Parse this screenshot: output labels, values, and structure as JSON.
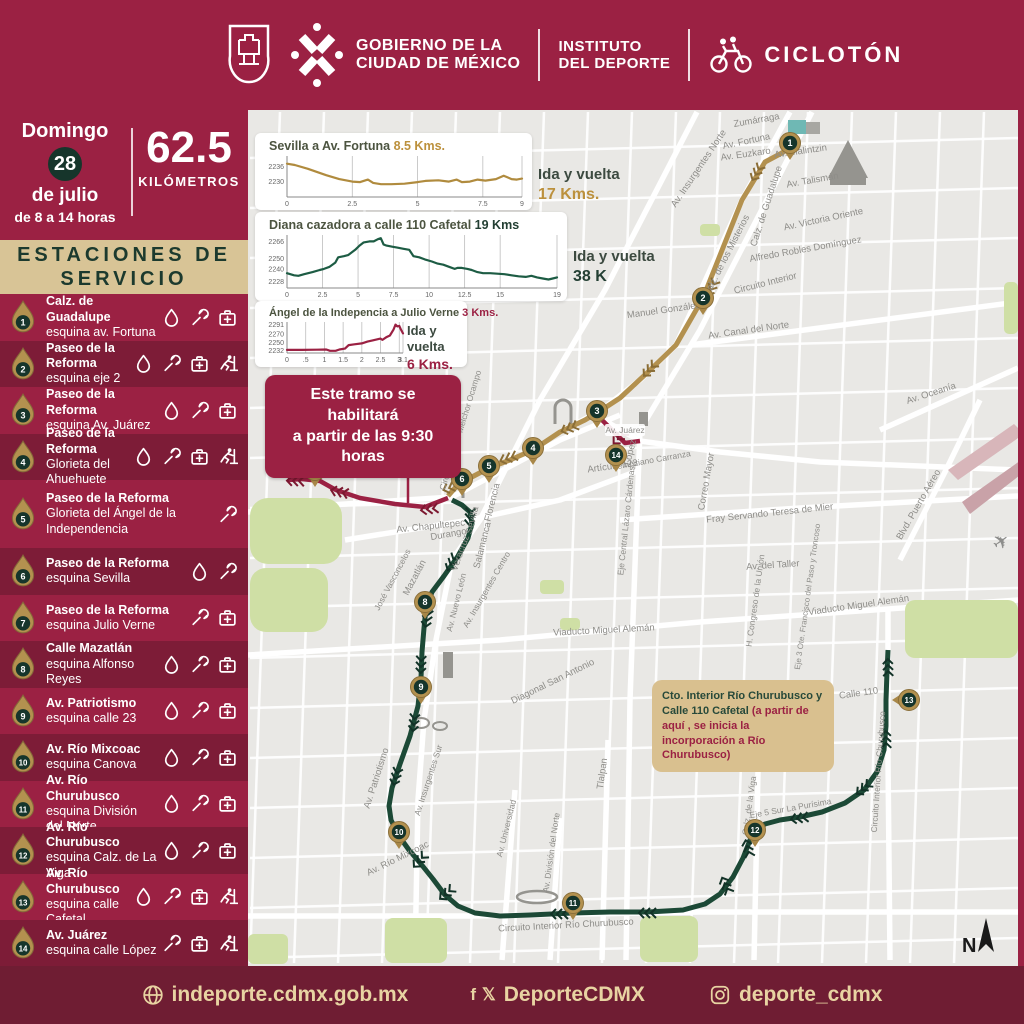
{
  "header": {
    "gov_line1": "GOBIERNO DE LA",
    "gov_line2": "CIUDAD DE MÉXICO",
    "inst_line1": "INSTITUTO",
    "inst_line2": "DEL DEPORTE",
    "event_name": "CICLOTÓN"
  },
  "sidebar": {
    "date": {
      "day_name": "Domingo",
      "day": "28",
      "month": "de julio",
      "hours": "de 8 a 14 horas"
    },
    "distance": {
      "value": "62.5",
      "unit": "KILÓMETROS"
    },
    "stations_title_line1": "ESTACIONES DE",
    "stations_title_line2": "SERVICIO",
    "stations": [
      {
        "num": "1",
        "line1": "Calz. de Guadalupe",
        "line2": "esquina av. Fortuna",
        "amenities": [
          "water",
          "wrench",
          "aid"
        ]
      },
      {
        "num": "2",
        "line1": "Paseo de la Reforma",
        "line2": "esquina eje 2",
        "amenities": [
          "water",
          "wrench",
          "aid",
          "runner"
        ]
      },
      {
        "num": "3",
        "line1": "Paseo de la Reforma",
        "line2": "esquina Av. Juárez",
        "amenities": [
          "water",
          "wrench",
          "aid"
        ]
      },
      {
        "num": "4",
        "line1": "Paseo de la Reforma",
        "line2": "Glorieta del Ahuehuete",
        "amenities": [
          "water",
          "wrench",
          "aid",
          "runner"
        ]
      },
      {
        "num": "5",
        "line1": "Paseo de la Reforma",
        "line2": "Glorieta del Ángel de la Independencia",
        "amenities": [
          "wrench"
        ]
      },
      {
        "num": "6",
        "line1": "Paseo de la Reforma",
        "line2": "esquina Sevilla",
        "amenities": [
          "water",
          "wrench"
        ]
      },
      {
        "num": "7",
        "line1": "Paseo de la Reforma",
        "line2": "esquina Julio Verne",
        "amenities": [
          "wrench",
          "aid"
        ]
      },
      {
        "num": "8",
        "line1": "Calle Mazatlán",
        "line2": "esquina Alfonso Reyes",
        "amenities": [
          "water",
          "wrench",
          "aid"
        ]
      },
      {
        "num": "9",
        "line1": "Av. Patriotismo",
        "line2": "esquina calle 23",
        "amenities": [
          "water",
          "wrench",
          "aid"
        ]
      },
      {
        "num": "10",
        "line1": "Av. Río Mixcoac",
        "line2": "esquina Canova",
        "amenities": [
          "water",
          "wrench",
          "aid"
        ]
      },
      {
        "num": "11",
        "line1": "Av. Río Churubusco",
        "line2": "esquina División del Norte",
        "amenities": [
          "water",
          "wrench",
          "aid"
        ]
      },
      {
        "num": "12",
        "line1": "Av. Río Churubusco",
        "line2": "esquina Calz. de La Viga",
        "amenities": [
          "water",
          "wrench",
          "aid"
        ]
      },
      {
        "num": "13",
        "line1": "Av. Río Churubusco",
        "line2": "esquina calle Cafetal",
        "amenities": [
          "water",
          "wrench",
          "aid",
          "runner"
        ]
      },
      {
        "num": "14",
        "line1": "Av. Juárez",
        "line2": "esquina calle López",
        "amenities": [
          "wrench",
          "aid",
          "runner"
        ]
      }
    ]
  },
  "chart_data": [
    {
      "type": "line",
      "title": "Sevilla a Av. Fortuna ",
      "highlight": "8.5 Kms.",
      "highlight_color": "#bc913d",
      "color": "#b08b3e",
      "note": "Ida y vuelta",
      "note_value": "17 Kms.",
      "note_value_color": "#bc913d",
      "xlim": [
        0,
        9
      ],
      "ylim": [
        2224,
        2240
      ],
      "xticks": [
        "0",
        "2.5",
        "5",
        "7.5",
        "9"
      ],
      "yticks": [
        2236,
        2230
      ],
      "points": [
        [
          0,
          2237
        ],
        [
          0.3,
          2236.5
        ],
        [
          0.8,
          2235
        ],
        [
          1.5,
          2232.5
        ],
        [
          2,
          2231
        ],
        [
          2.5,
          2230
        ],
        [
          2.8,
          2229.8
        ],
        [
          3.1,
          2230.8
        ],
        [
          3.3,
          2229.5
        ],
        [
          3.6,
          2229
        ],
        [
          4,
          2229
        ],
        [
          4.5,
          2229.2
        ],
        [
          5,
          2229.8
        ],
        [
          5.3,
          2230.3
        ],
        [
          5.8,
          2230.5
        ],
        [
          6.2,
          2230
        ],
        [
          6.5,
          2230.8
        ],
        [
          6.7,
          2229.8
        ],
        [
          7,
          2230
        ],
        [
          7.3,
          2230.8
        ],
        [
          7.6,
          2230.4
        ],
        [
          8,
          2231
        ],
        [
          8.3,
          2232.3
        ],
        [
          8.6,
          2231
        ],
        [
          8.8,
          2230.8
        ],
        [
          9,
          2231.2
        ]
      ]
    },
    {
      "type": "line",
      "title": "Diana cazadora a calle 110 Cafetal ",
      "highlight": "19 Kms",
      "highlight_color": "#233f33",
      "color": "#1d5c44",
      "note": "Ida y vuelta",
      "note_value": "38 K",
      "note_value_color": "#233f33",
      "xlim": [
        0,
        19
      ],
      "ylim": [
        2222,
        2272
      ],
      "xticks": [
        "0",
        "2.5",
        "5",
        "7.5",
        "10",
        "12.5",
        "15",
        "19"
      ],
      "yticks": [
        2266,
        2250,
        2240,
        2228
      ],
      "points": [
        [
          0,
          2236
        ],
        [
          0.5,
          2234
        ],
        [
          0.8,
          2233.5
        ],
        [
          1.2,
          2235
        ],
        [
          1.8,
          2237
        ],
        [
          2.3,
          2239
        ],
        [
          2.6,
          2240
        ],
        [
          3,
          2242
        ],
        [
          3.4,
          2246
        ],
        [
          3.6,
          2251
        ],
        [
          4,
          2252
        ],
        [
          4.3,
          2253
        ],
        [
          4.8,
          2258
        ],
        [
          5.1,
          2262
        ],
        [
          5.4,
          2265
        ],
        [
          5.8,
          2266
        ],
        [
          6.1,
          2266
        ],
        [
          6.4,
          2268
        ],
        [
          6.6,
          2269
        ],
        [
          6.8,
          2263
        ],
        [
          7,
          2262
        ],
        [
          7.4,
          2261
        ],
        [
          7.8,
          2260
        ],
        [
          8.2,
          2259
        ],
        [
          8.6,
          2258
        ],
        [
          8.9,
          2252
        ],
        [
          9.3,
          2251
        ],
        [
          9.7,
          2249
        ],
        [
          10.2,
          2247
        ],
        [
          10.6,
          2245
        ],
        [
          11,
          2244
        ],
        [
          11.4,
          2242
        ],
        [
          11.8,
          2240
        ],
        [
          12,
          2241
        ],
        [
          12.3,
          2241
        ],
        [
          12.7,
          2240
        ],
        [
          13,
          2239
        ],
        [
          13.4,
          2237
        ],
        [
          13.8,
          2236
        ],
        [
          14.3,
          2236
        ],
        [
          14.8,
          2235.5
        ],
        [
          15.3,
          2235
        ],
        [
          15.8,
          2234
        ],
        [
          16.3,
          2233
        ],
        [
          16.8,
          2232.5
        ],
        [
          17.2,
          2233.5
        ],
        [
          17.6,
          2232
        ],
        [
          18,
          2231
        ],
        [
          18.4,
          2230
        ],
        [
          18.7,
          2231
        ],
        [
          19,
          2232
        ]
      ]
    },
    {
      "type": "line",
      "title": "Ángel de la Indepencia a Julio Verne ",
      "highlight": "3 Kms.",
      "highlight_color": "#9b2143",
      "color": "#9b2143",
      "note": "Ida y vuelta",
      "note_value": "6 Kms.",
      "note_value_color": "#9b2143",
      "xlim": [
        0,
        3.1
      ],
      "ylim": [
        2226,
        2297
      ],
      "xticks": [
        "0",
        ".5",
        "1",
        "1.5",
        "2",
        "2.5",
        "3",
        "3.1"
      ],
      "yticks": [
        2291,
        2270,
        2250,
        2232
      ],
      "points": [
        [
          0,
          2233
        ],
        [
          0.4,
          2233
        ],
        [
          0.8,
          2233.5
        ],
        [
          1.05,
          2234
        ],
        [
          1.15,
          2231
        ],
        [
          1.3,
          2231
        ],
        [
          1.4,
          2234
        ],
        [
          1.55,
          2236
        ],
        [
          1.65,
          2244
        ],
        [
          1.8,
          2246
        ],
        [
          2,
          2248
        ],
        [
          2.15,
          2252
        ],
        [
          2.3,
          2255
        ],
        [
          2.5,
          2259
        ],
        [
          2.55,
          2256
        ],
        [
          2.65,
          2262
        ],
        [
          2.75,
          2266
        ],
        [
          2.85,
          2280
        ],
        [
          2.9,
          2291
        ],
        [
          2.95,
          2287
        ],
        [
          3,
          2288
        ],
        [
          3.05,
          2279
        ],
        [
          3.1,
          2271
        ]
      ]
    }
  ],
  "callouts": {
    "tramo_line1": "Este tramo se habilitará",
    "tramo_line2": "a partir de las 9:30 horas",
    "cafetal_green": "Cto. Interior Río Churubusco y Calle 110 Cafetal ",
    "cafetal_maroon": "(a partir de aquí , se inicia la incorporación a Río Churubusco)"
  },
  "map": {
    "route_colors": {
      "gold": "#b3914f",
      "maroon": "#9b2143",
      "green": "#1c4936"
    },
    "markers": [
      {
        "n": "1",
        "x": 790,
        "y": 143
      },
      {
        "n": "2",
        "x": 703,
        "y": 298
      },
      {
        "n": "3",
        "x": 597,
        "y": 411
      },
      {
        "n": "4",
        "x": 533,
        "y": 448
      },
      {
        "n": "5",
        "x": 489,
        "y": 466
      },
      {
        "n": "6",
        "x": 462,
        "y": 479
      },
      {
        "n": "7",
        "x": 315,
        "y": 470
      },
      {
        "n": "8",
        "x": 425,
        "y": 602
      },
      {
        "n": "9",
        "x": 421,
        "y": 687
      },
      {
        "n": "10",
        "x": 399,
        "y": 832
      },
      {
        "n": "11",
        "x": 573,
        "y": 903
      },
      {
        "n": "12",
        "x": 755,
        "y": 830
      },
      {
        "n": "13",
        "x": 909,
        "y": 700,
        "rot": 90
      },
      {
        "n": "14",
        "x": 616,
        "y": 455
      }
    ],
    "labels": [
      {
        "t": "Zumárraga",
        "x": 757,
        "y": 123,
        "r": -10
      },
      {
        "t": "Av. Insurgentes Norte",
        "x": 701,
        "y": 170,
        "r": -56
      },
      {
        "t": "Av. Fortuna",
        "x": 747,
        "y": 144,
        "r": -12
      },
      {
        "t": "Av. Euzkaro",
        "x": 746,
        "y": 157,
        "r": -8
      },
      {
        "t": "Av. Malintzin",
        "x": 801,
        "y": 154,
        "r": -8
      },
      {
        "t": "Av. Talismán",
        "x": 813,
        "y": 183,
        "r": -10
      },
      {
        "t": "Av. Victoria Oriente",
        "x": 824,
        "y": 222,
        "r": -12
      },
      {
        "t": "Alfredo Robles Domínguez",
        "x": 806,
        "y": 252,
        "r": -10
      },
      {
        "t": "Calz. de Guadalupe",
        "x": 769,
        "y": 207,
        "r": -72
      },
      {
        "t": "Calz. de los Misterios",
        "x": 729,
        "y": 257,
        "r": -63
      },
      {
        "t": "Circuito Interior",
        "x": 766,
        "y": 286,
        "r": -14
      },
      {
        "t": "Manuel González",
        "x": 664,
        "y": 313,
        "r": -8
      },
      {
        "t": "Av. Canal del Norte",
        "x": 749,
        "y": 333,
        "r": -8
      },
      {
        "t": "Av. Oceanía",
        "x": 932,
        "y": 396,
        "r": -18
      },
      {
        "t": "Blvd. Puerto Aéreo",
        "x": 921,
        "y": 506,
        "r": -60
      },
      {
        "t": "Fray Servando Teresa de Mier",
        "x": 770,
        "y": 516,
        "r": -6
      },
      {
        "t": "Correo Mayor",
        "x": 709,
        "y": 482,
        "r": -80
      },
      {
        "t": "Av. del Taller",
        "x": 773,
        "y": 568,
        "r": -4
      },
      {
        "t": "H. Congreso de la Unión",
        "x": 758,
        "y": 601,
        "r": -82,
        "s": 8.5
      },
      {
        "t": "Eje 3 Ote. Francisco del Paso y Troncoso",
        "x": 810,
        "y": 597,
        "r": -82,
        "s": 8
      },
      {
        "t": "Viaducto Miguel Alemán",
        "x": 859,
        "y": 608,
        "r": -8
      },
      {
        "t": "Circuito Interior Melchor Ocampo",
        "x": 463,
        "y": 431,
        "r": -73,
        "s": 8.5
      },
      {
        "t": "López",
        "x": 633,
        "y": 453,
        "r": -76
      },
      {
        "t": "Artículo 123",
        "x": 613,
        "y": 469,
        "r": -8
      },
      {
        "t": "Venustiano Carranza",
        "x": 652,
        "y": 463,
        "r": -10,
        "s": 8.5
      },
      {
        "t": "Eje Central Lázaro Cárdenas",
        "x": 629,
        "y": 521,
        "r": -84,
        "s": 8.5
      },
      {
        "t": "Av. Chapultepec",
        "x": 431,
        "y": 529,
        "r": -6
      },
      {
        "t": "Sevilla",
        "x": 475,
        "y": 521,
        "r": -76
      },
      {
        "t": "Florencia",
        "x": 495,
        "y": 503,
        "r": -76
      },
      {
        "t": "Salamanca",
        "x": 485,
        "y": 546,
        "r": -76
      },
      {
        "t": "Durango",
        "x": 449,
        "y": 537,
        "r": -10
      },
      {
        "t": "Veracruz",
        "x": 463,
        "y": 554,
        "r": -70
      },
      {
        "t": "José Vasconcelos",
        "x": 395,
        "y": 581,
        "r": -62,
        "s": 8.5
      },
      {
        "t": "Mazatlán",
        "x": 417,
        "y": 579,
        "r": -62
      },
      {
        "t": "Av. Nuevo León",
        "x": 459,
        "y": 603,
        "r": -76,
        "s": 8.5
      },
      {
        "t": "Av. Insurgentes Centro",
        "x": 489,
        "y": 591,
        "r": -60,
        "s": 8.5
      },
      {
        "t": "Viaducto Miguel Alemán",
        "x": 604,
        "y": 633,
        "r": -3
      },
      {
        "t": "Diagonal San Antonio",
        "x": 554,
        "y": 684,
        "r": -26
      },
      {
        "t": "Av. Patriotismo",
        "x": 379,
        "y": 779,
        "r": -72
      },
      {
        "t": "Av. Insurgentes Sur",
        "x": 431,
        "y": 781,
        "r": -72,
        "s": 8.5
      },
      {
        "t": "Tlalpan",
        "x": 605,
        "y": 774,
        "r": -82
      },
      {
        "t": "Av. Río Mixcoac",
        "x": 399,
        "y": 861,
        "r": -26
      },
      {
        "t": "Av. Universidad",
        "x": 509,
        "y": 829,
        "r": -76,
        "s": 8.5
      },
      {
        "t": "Av. División del Norte",
        "x": 554,
        "y": 853,
        "r": -82,
        "s": 8.5
      },
      {
        "t": "Circuito Interior Río Churubusco",
        "x": 566,
        "y": 928,
        "r": -3
      },
      {
        "t": "Calz. de la Viga",
        "x": 752,
        "y": 806,
        "r": -82,
        "s": 8.5
      },
      {
        "t": "Eje 5 Sur La Purísima",
        "x": 791,
        "y": 811,
        "r": -10,
        "s": 8.5
      },
      {
        "t": "Calle 110",
        "x": 859,
        "y": 696,
        "r": -8
      },
      {
        "t": "Circuito Interior Río Churubusco",
        "x": 881,
        "y": 772,
        "r": -86,
        "s": 8.5
      }
    ],
    "juarez_chip": "Av. Juárez",
    "north_label": "N"
  },
  "footer": {
    "website": "indeporte.cdmx.gob.mx",
    "social": "DeporteCDMX",
    "instagram": "deporte_cdmx"
  },
  "colors": {
    "maroon": "#9b2143",
    "maroon_dark_row": "#7d1c37",
    "maroon_footer": "#6f1d33",
    "tan": "#d8c496",
    "green_dark": "#16352b",
    "gold": "#b3914f",
    "map_bg": "#e9e8e5",
    "park": "#cfdfa5",
    "street": "#ffffff",
    "airport": "#d8b6ba"
  }
}
